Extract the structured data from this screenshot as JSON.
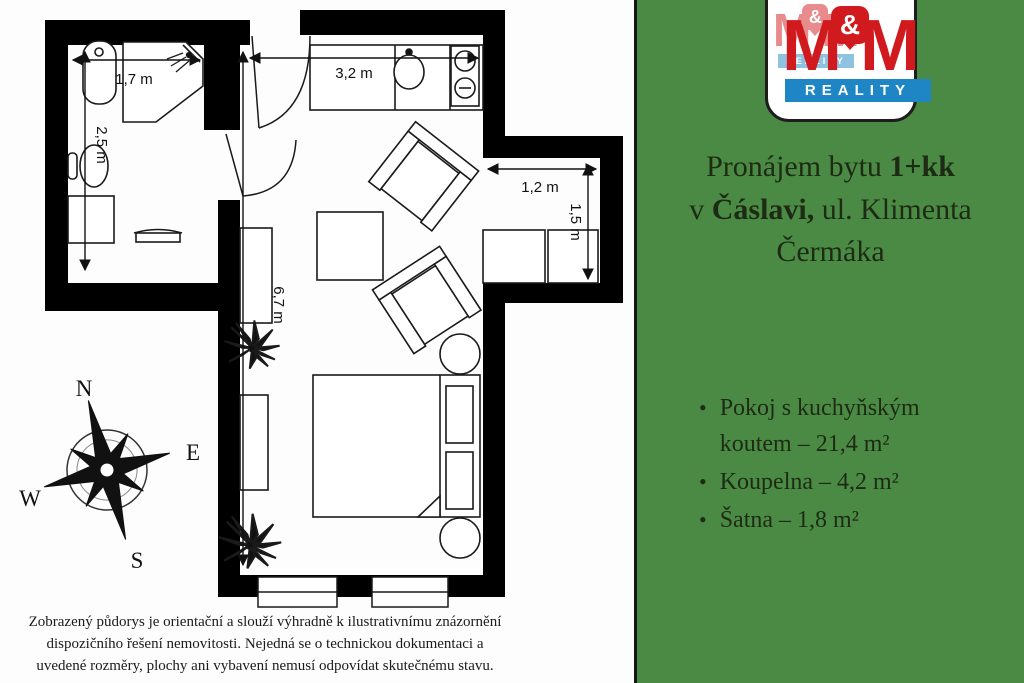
{
  "plan": {
    "dims": {
      "bath_w": "1,7 m",
      "bath_h": "2,5 m",
      "kitchen_w": "3,2 m",
      "room_h": "6,7 m",
      "niche_w": "1,2 m",
      "niche_h": "1,5 m"
    },
    "compass": {
      "n": "N",
      "e": "E",
      "s": "S",
      "w": "W"
    }
  },
  "logo": {
    "m": "M",
    "amp": "&",
    "reality": "REALITY"
  },
  "panel": {
    "title": {
      "l1a": "Pronájem bytu ",
      "l1b": "1+kk",
      "l2a": "v ",
      "l2b": "Čáslavi,",
      "l2c": " ul. Klimenta",
      "l3": "Čermáka"
    },
    "bullets": [
      {
        "line1": "Pokoj s kuchyňským",
        "line2": "koutem – 21,4 m²"
      },
      {
        "line1": "Koupelna – 4,2 m²",
        "line2": ""
      },
      {
        "line1": "Šatna – 1,8 m²",
        "line2": ""
      }
    ]
  },
  "disclaimer": {
    "line1": "Zobrazený půdorys je orientační a slouží výhradně k ilustrativnímu znázornění",
    "line2": "dispozičního řešení nemovitosti. Nejedná se o technickou dokumentaci a",
    "line3": "uvedené rozměry, plochy ani vybavení nemusí odpovídat skutečnému stavu."
  },
  "colors": {
    "panel_green": "#4b8a44",
    "logo_red": "#d11a1e",
    "logo_blue": "#1f86c5",
    "wall_black": "#000000"
  }
}
